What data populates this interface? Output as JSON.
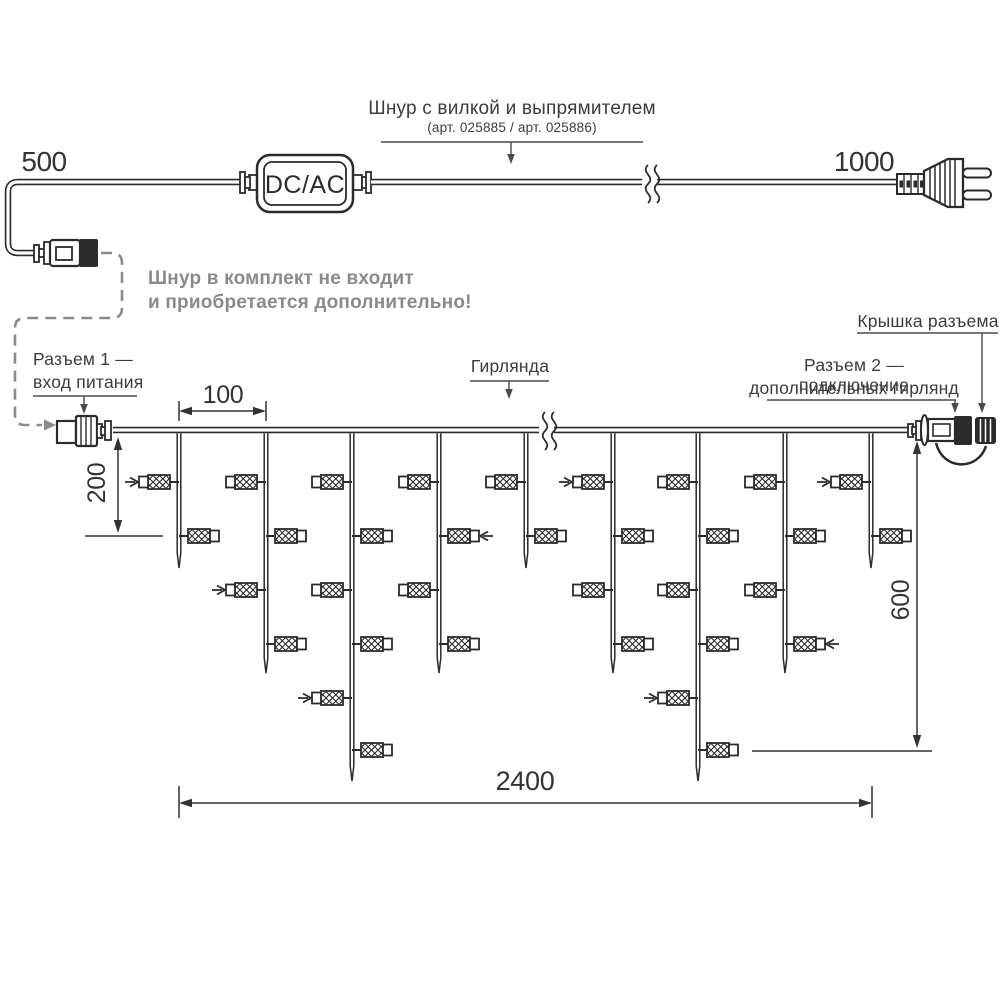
{
  "colors": {
    "ink": "#2b2b2b",
    "leader": "#4a4a4a",
    "gray": "#8a8a8a",
    "background": "#ffffff"
  },
  "power_cord": {
    "dim_left": "500",
    "dim_right": "1000",
    "converter_label": "DC/AC",
    "callout_title": "Шнур с вилкой и выпрямителем",
    "callout_subtitle": "(арт. 025885  /  арт. 025886)",
    "note_line1": "Шнур в комплект не входит",
    "note_line2": "и приобретается дополнительно!"
  },
  "garland": {
    "connector1_line1": "Разъем 1 —",
    "connector1_line2": "вход питания",
    "garland_label": "Гирлянда",
    "connector2_line1": "Разъем 2 — подключение",
    "connector2_line2": "дополнительных гирлянд",
    "cap_label": "Крышка разъема",
    "dim_spacing": "100",
    "dim_drop_short": "200",
    "dim_drop_long": "600",
    "dim_length": "2400"
  }
}
